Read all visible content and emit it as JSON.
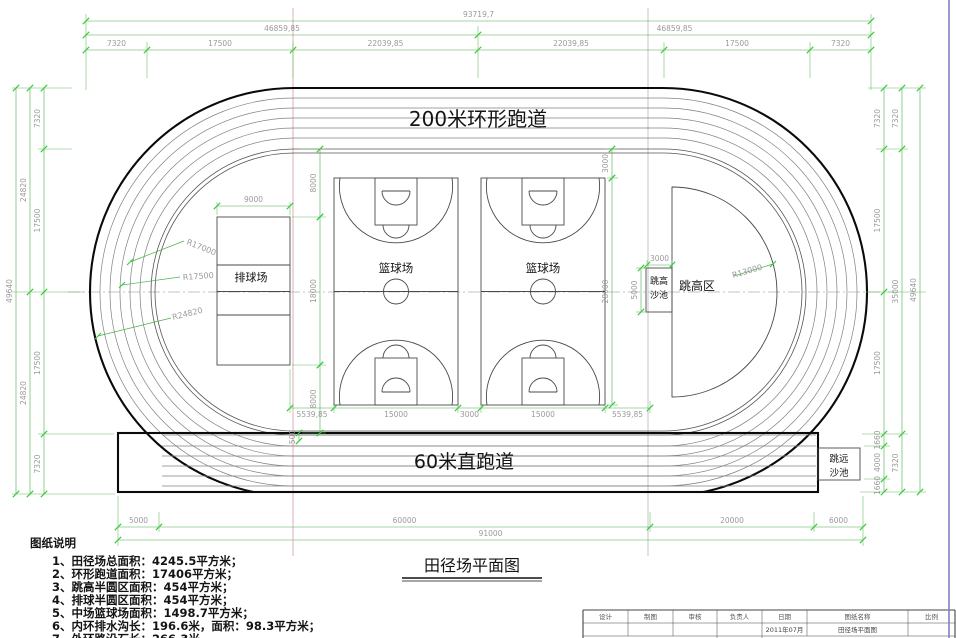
{
  "drawing": {
    "ring_track_label": "200米环形跑道",
    "straight_track_label": "60米直跑道",
    "basketball_label": "篮球场",
    "volleyball_label": "排球场",
    "high_jump_area_label": "跳高区",
    "high_jump_pit_line1": "跳高",
    "high_jump_pit_line2": "沙池",
    "long_jump_pit_line1": "跳远",
    "long_jump_pit_line2": "沙池",
    "title": "田径场平面图"
  },
  "radius_labels": {
    "r17000": "R17000",
    "r17500": "R17500",
    "r24820": "R24820",
    "r13000": "R13000"
  },
  "dims": {
    "top1": [
      "7320",
      "17500",
      "22039,85",
      "22039,85",
      "17500",
      "7320"
    ],
    "top2": [
      "46859,85",
      "46859,85"
    ],
    "top3": [
      "93719,7"
    ],
    "left1": [
      "7320",
      "17500",
      "17500",
      "7320"
    ],
    "left2": [
      "24820",
      "24820"
    ],
    "left3": [
      "49640"
    ],
    "right1": [
      "7320",
      "17500",
      "17500",
      "1660",
      "4000",
      "1660"
    ],
    "right2": [
      "7320",
      "35000",
      "7320"
    ],
    "right3": [
      "49640"
    ],
    "bottom1": [
      "5000",
      "60000",
      "20000",
      "6000"
    ],
    "bottom2": [
      "91000"
    ],
    "inner": {
      "vb_width": "9000",
      "gap_top": "8000",
      "vb_height": "18000",
      "gap_bottom": "8000",
      "court_row": [
        "5539,85",
        "15000",
        "3000",
        "15000",
        "5539,85"
      ],
      "bb_offset_top": "3000",
      "bb_height": "28000",
      "hj_pit_width": "3000",
      "hj_pit_height": "5000",
      "curb_gap": "500"
    }
  },
  "notes": {
    "heading": "图纸说明",
    "items": [
      "1、田径场总面积：4245.5平方米；",
      "2、环形跑道面积：17406平方米；",
      "3、跳高半圆区面积：454平方米；",
      "4、排球半圆区面积：454平方米；",
      "5、中场篮球场面积：1498.7平方米；",
      "6、内环排水沟长：196.6米，面积：98.3平方米；",
      "7、外环路沿石长：266.3米."
    ]
  },
  "titleblock": {
    "headers": [
      "设计",
      "制图",
      "审核",
      "负责人",
      "日期",
      "图纸名称",
      "比例"
    ],
    "date_value": "2011年07月",
    "drawing_name_value": "田径场平面图"
  },
  "colors": {
    "dim_line": "#4fae4f",
    "dim_tick": "#2ecc2e",
    "dim_text": "#9a9a9a",
    "outline": "#0a0a0a",
    "detail": "#4a4a4a",
    "centerline_vertical": "#cf9d9d",
    "frame_border": "#8080c0"
  }
}
